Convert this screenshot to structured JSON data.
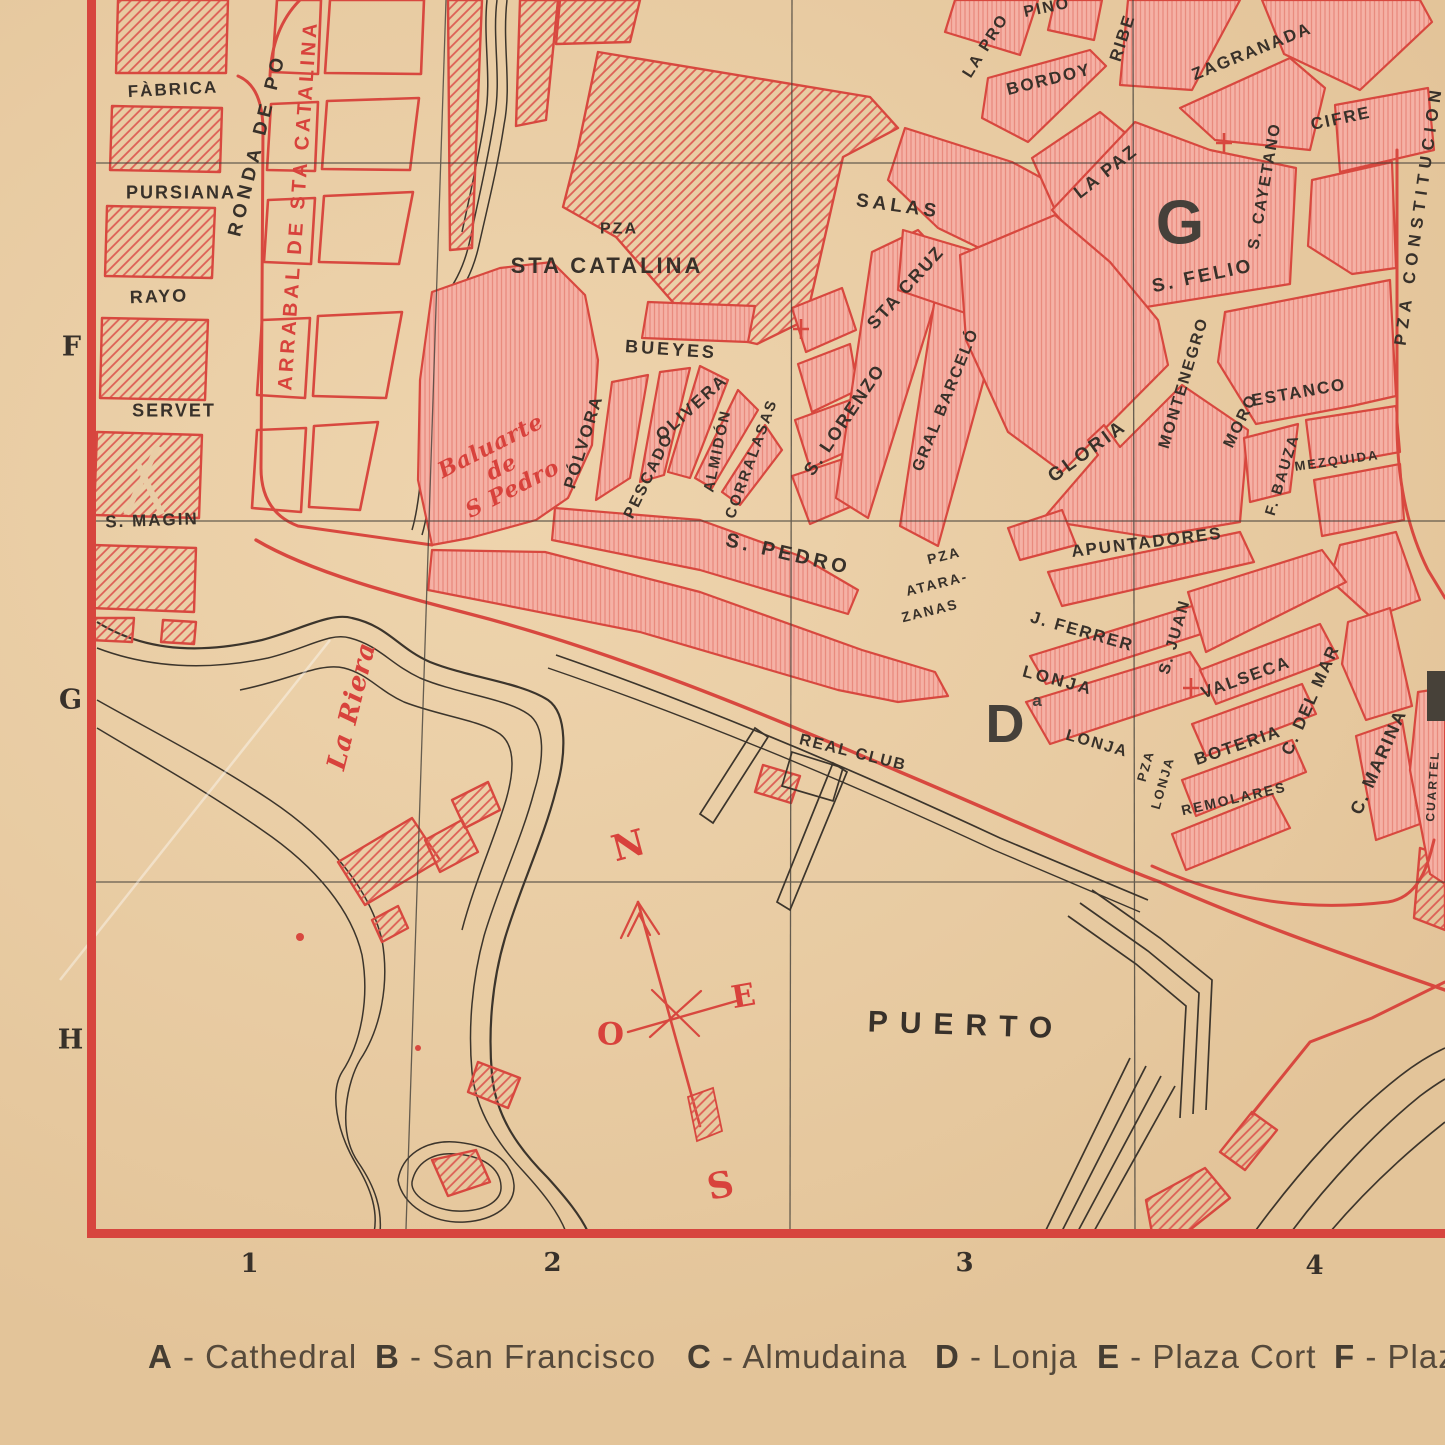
{
  "colors": {
    "paper": "#e9cda6",
    "block_salmon": "#f5b1a5",
    "map_red": "#d8483f",
    "red_text": "#d8423c",
    "ink": "#38312a",
    "big_letter": "#45403a"
  },
  "legend": {
    "sep": " - ",
    "items": [
      {
        "key": "A",
        "name": "Cathedral",
        "x": 148
      },
      {
        "key": "B",
        "name": "San Francisco",
        "x": 375
      },
      {
        "key": "C",
        "name": "Almudaina",
        "x": 687
      },
      {
        "key": "D",
        "name": "Lonja",
        "x": 935
      },
      {
        "key": "E",
        "name": "Plaza Cort",
        "x": 1097
      },
      {
        "key": "F",
        "name": "Plaz",
        "x": 1334
      }
    ]
  },
  "map": {
    "grid_rows": [
      "F",
      "G",
      "H"
    ],
    "grid_cols": [
      "1",
      "2",
      "3",
      "4"
    ],
    "compass_points": [
      "N",
      "E",
      "O",
      "S"
    ],
    "labels": [
      {
        "t": "FÀBRICA",
        "x": 173,
        "y": 90,
        "r": -3,
        "s": 17
      },
      {
        "t": "PURSIANA",
        "x": 181,
        "y": 193,
        "r": 0,
        "s": 18
      },
      {
        "t": "RAYO",
        "x": 159,
        "y": 297,
        "r": -2,
        "s": 18
      },
      {
        "t": "SERVET",
        "x": 174,
        "y": 411,
        "r": 0,
        "s": 18
      },
      {
        "t": "S. MAGIN",
        "x": 152,
        "y": 521,
        "r": -2,
        "s": 17
      },
      {
        "t": "RONDA DE PO",
        "x": 258,
        "y": 145,
        "r": -76,
        "s": 19,
        "ls": 5
      },
      {
        "t": "PZA",
        "x": 619,
        "y": 229,
        "r": 0,
        "s": 16
      },
      {
        "t": "STA CATALINA",
        "x": 607,
        "y": 266,
        "r": 0,
        "s": 22,
        "ls": 3
      },
      {
        "t": "SALAS",
        "x": 898,
        "y": 207,
        "r": 8,
        "s": 19,
        "ls": 4
      },
      {
        "t": "STA CRUZ",
        "x": 906,
        "y": 288,
        "r": -48,
        "s": 18
      },
      {
        "t": "BUEYES",
        "x": 671,
        "y": 350,
        "r": 4,
        "s": 18,
        "ls": 3
      },
      {
        "t": "OLIVERA",
        "x": 692,
        "y": 408,
        "r": -42,
        "s": 17
      },
      {
        "t": "PÓLVORA",
        "x": 584,
        "y": 442,
        "r": -73,
        "s": 17
      },
      {
        "t": "PESCADO",
        "x": 649,
        "y": 476,
        "r": -64,
        "s": 16
      },
      {
        "t": "ALMIDÓN",
        "x": 718,
        "y": 451,
        "r": -78,
        "s": 15
      },
      {
        "t": "CORRALASAS",
        "x": 752,
        "y": 459,
        "r": -70,
        "s": 15
      },
      {
        "t": "S. LORENZO",
        "x": 845,
        "y": 420,
        "r": -56,
        "s": 18
      },
      {
        "t": "GRAL BARCELÓ",
        "x": 946,
        "y": 400,
        "r": -68,
        "s": 16
      },
      {
        "t": "LA PRO",
        "x": 986,
        "y": 46,
        "r": -58,
        "s": 16
      },
      {
        "t": "PINO",
        "x": 1047,
        "y": 8,
        "r": -12,
        "s": 16
      },
      {
        "t": "BORDOY",
        "x": 1049,
        "y": 80,
        "r": -14,
        "s": 17
      },
      {
        "t": "RIBE",
        "x": 1123,
        "y": 38,
        "r": -72,
        "s": 17
      },
      {
        "t": "LA PAZ",
        "x": 1106,
        "y": 172,
        "r": -38,
        "s": 18
      },
      {
        "t": "ZAGRANADA",
        "x": 1252,
        "y": 52,
        "r": -22,
        "s": 17
      },
      {
        "t": "CIFRE",
        "x": 1341,
        "y": 119,
        "r": -12,
        "s": 17
      },
      {
        "t": "S. CAYETANO",
        "x": 1265,
        "y": 186,
        "r": -80,
        "s": 16
      },
      {
        "t": "S. FELIO",
        "x": 1203,
        "y": 277,
        "r": -12,
        "s": 19,
        "ls": 3
      },
      {
        "t": "PZA CONSTITUCION",
        "x": 1419,
        "y": 215,
        "r": -82,
        "s": 17,
        "ls": 6
      },
      {
        "t": "MONTENEGRO",
        "x": 1184,
        "y": 383,
        "r": -73,
        "s": 16
      },
      {
        "t": "MORO",
        "x": 1241,
        "y": 421,
        "r": -64,
        "s": 16
      },
      {
        "t": "ESTANCO",
        "x": 1299,
        "y": 393,
        "r": -10,
        "s": 17,
        "ls": 2
      },
      {
        "t": "MEZQUIDA",
        "x": 1337,
        "y": 461,
        "r": -8,
        "s": 13
      },
      {
        "t": "F. BAUZA",
        "x": 1283,
        "y": 475,
        "r": -73,
        "s": 15
      },
      {
        "t": "GLORIA",
        "x": 1088,
        "y": 452,
        "r": -36,
        "s": 19,
        "ls": 3
      },
      {
        "t": "APUNTADORES",
        "x": 1147,
        "y": 543,
        "r": -7,
        "s": 17,
        "ls": 2
      },
      {
        "t": "S. PEDRO",
        "x": 788,
        "y": 555,
        "r": 13,
        "s": 20,
        "ls": 4
      },
      {
        "t": "PZA",
        "x": 944,
        "y": 556,
        "r": -14,
        "s": 14
      },
      {
        "t": "ATARA-",
        "x": 937,
        "y": 584,
        "r": -14,
        "s": 14
      },
      {
        "t": "ZANAS",
        "x": 930,
        "y": 611,
        "r": -14,
        "s": 14
      },
      {
        "t": "J. FERRER",
        "x": 1082,
        "y": 632,
        "r": 16,
        "s": 17,
        "ls": 2
      },
      {
        "t": "LONJA",
        "x": 1058,
        "y": 681,
        "r": 15,
        "s": 17,
        "ls": 3
      },
      {
        "t": "ª",
        "x": 1037,
        "y": 706,
        "r": 0,
        "s": 26,
        "f": "big"
      },
      {
        "t": "LONJA",
        "x": 1097,
        "y": 744,
        "r": 16,
        "s": 16,
        "ls": 2
      },
      {
        "t": "S. JUAN",
        "x": 1175,
        "y": 637,
        "r": -74,
        "s": 16
      },
      {
        "t": "VALSECA",
        "x": 1246,
        "y": 678,
        "r": -20,
        "s": 17,
        "ls": 2
      },
      {
        "t": "BOTERIA",
        "x": 1238,
        "y": 746,
        "r": -19,
        "s": 17,
        "ls": 2
      },
      {
        "t": "PZA",
        "x": 1146,
        "y": 766,
        "r": -74,
        "s": 13
      },
      {
        "t": "LONJA",
        "x": 1163,
        "y": 783,
        "r": -74,
        "s": 13
      },
      {
        "t": "REMOLARES",
        "x": 1234,
        "y": 799,
        "r": -13,
        "s": 14
      },
      {
        "t": "C. DEL MAR",
        "x": 1311,
        "y": 700,
        "r": -66,
        "s": 17
      },
      {
        "t": "C. MARINA",
        "x": 1379,
        "y": 762,
        "r": -66,
        "s": 18
      },
      {
        "t": "CUARTEL",
        "x": 1433,
        "y": 786,
        "r": -86,
        "s": 12
      },
      {
        "t": "REAL CLUB",
        "x": 853,
        "y": 753,
        "r": 14,
        "s": 16,
        "ls": 2
      },
      {
        "t": "PUERTO",
        "x": 966,
        "y": 1026,
        "r": 2,
        "s": 30,
        "ls": 12
      },
      {
        "t": "ARRABAL DE STA CATALINA",
        "x": 299,
        "y": 205,
        "r": -86,
        "s": 20,
        "ls": 4,
        "c": "red"
      },
      {
        "t": "Baluarte\nde\nS Pedro",
        "x": 502,
        "y": 468,
        "r": -27,
        "s": 22,
        "c": "red",
        "f": "script"
      },
      {
        "t": "La Riera",
        "x": 352,
        "y": 706,
        "r": -76,
        "s": 26,
        "c": "red",
        "f": "script"
      },
      {
        "t": "F",
        "x": 72,
        "y": 347,
        "r": 0,
        "s": 27,
        "f": "serif"
      },
      {
        "t": "G",
        "x": 71,
        "y": 700,
        "r": 0,
        "s": 27,
        "f": "serif"
      },
      {
        "t": "H",
        "x": 71,
        "y": 1040,
        "r": 0,
        "s": 27,
        "f": "serif"
      },
      {
        "t": "1",
        "x": 250,
        "y": 1264,
        "r": 0,
        "s": 26,
        "f": "serif"
      },
      {
        "t": "2",
        "x": 553,
        "y": 1263,
        "r": 0,
        "s": 26,
        "f": "serif"
      },
      {
        "t": "3",
        "x": 965,
        "y": 1263,
        "r": 0,
        "s": 26,
        "f": "serif"
      },
      {
        "t": "4",
        "x": 1315,
        "y": 1266,
        "r": 0,
        "s": 26,
        "f": "serif"
      },
      {
        "t": "G",
        "x": 1180,
        "y": 224,
        "r": 0,
        "s": 62,
        "f": "big"
      },
      {
        "t": "D",
        "x": 1005,
        "y": 724,
        "r": 0,
        "s": 54,
        "f": "big"
      },
      {
        "t": "N",
        "x": 629,
        "y": 846,
        "r": -15,
        "s": 36,
        "c": "red",
        "f": "serif"
      },
      {
        "t": "E",
        "x": 744,
        "y": 997,
        "r": -10,
        "s": 31,
        "c": "red",
        "f": "serif"
      },
      {
        "t": "O",
        "x": 611,
        "y": 1035,
        "r": 0,
        "s": 31,
        "c": "red",
        "f": "serif"
      },
      {
        "t": "S",
        "x": 721,
        "y": 1186,
        "r": -12,
        "s": 36,
        "c": "red",
        "f": "serif"
      }
    ]
  }
}
